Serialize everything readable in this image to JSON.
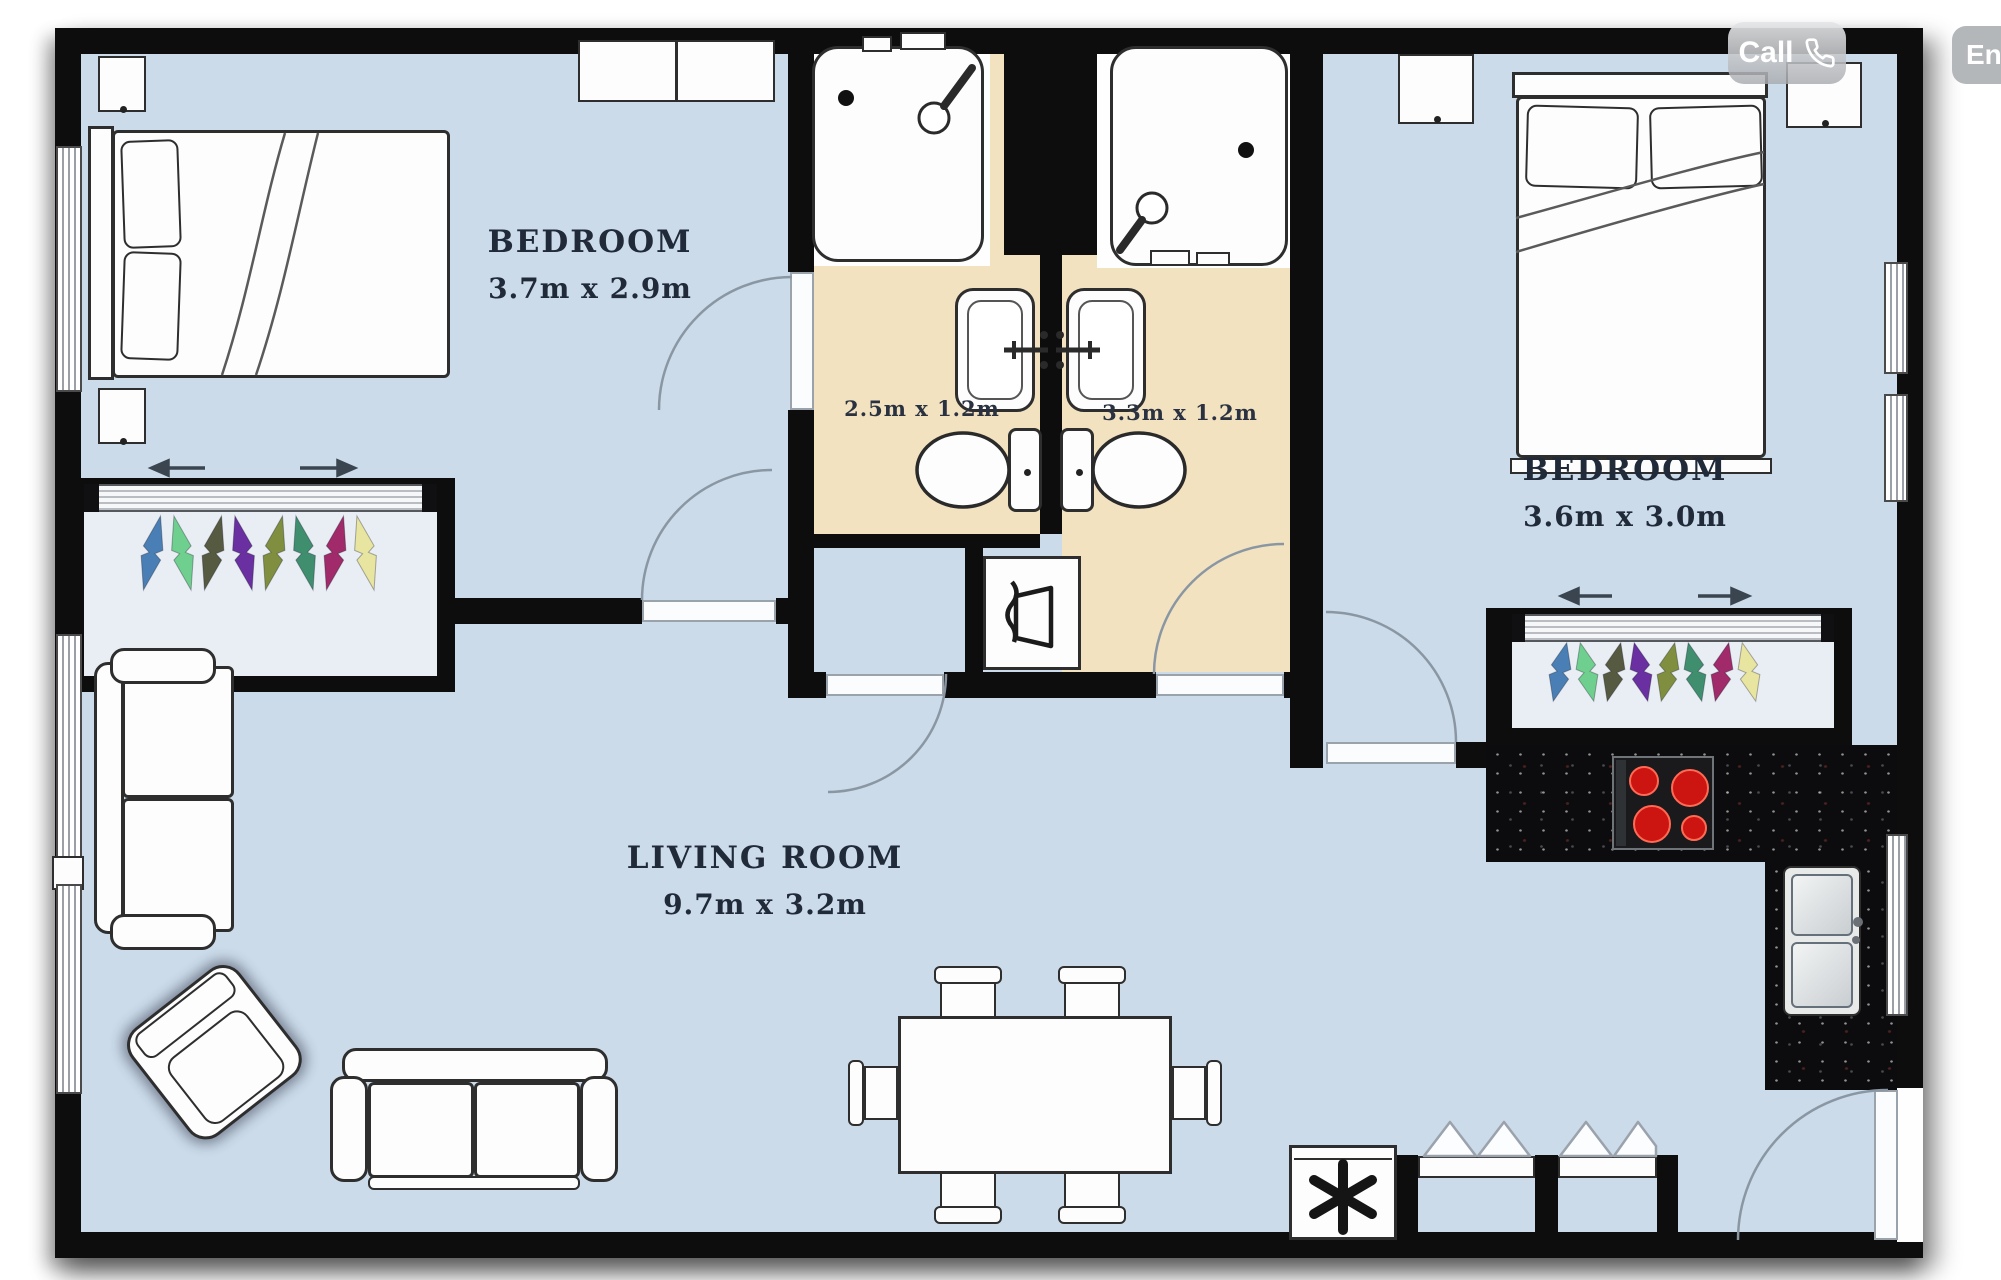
{
  "overlay_buttons": {
    "call": {
      "label": "Call",
      "icon": "phone-icon",
      "background": "#c7c9cc",
      "text_color": "#ffffff"
    },
    "enquire": {
      "label": "En",
      "background": "#b4b7ba",
      "text_color": "#ffffff"
    }
  },
  "floorplan": {
    "rooms": {
      "bedroom_left": {
        "name": "BEDROOM",
        "dimensions": "3.7m x 2.9m"
      },
      "bedroom_right": {
        "name": "BEDROOM",
        "dimensions": "3.6m x 3.0m"
      },
      "living_room": {
        "name": "LIVING ROOM",
        "dimensions": "9.7m x 3.2m"
      },
      "bathroom_left": {
        "dimensions": "2.5m x 1.2m"
      },
      "bathroom_right": {
        "dimensions": "3.3m x 1.2m"
      }
    },
    "colors": {
      "wall": "#0d0d0e",
      "floor": "#cbdbea",
      "bathroom_floor": "#f2e2c0",
      "label_text": "#202a38",
      "kitchen_counter": "#0c0c0e",
      "stove_burner": "#cc1410"
    },
    "wardrobe_clothes_colors": [
      "#4a7fb5",
      "#6fcf8e",
      "#555a40",
      "#6a2fa0",
      "#7f8f3f",
      "#3f8f6f",
      "#a02a6a",
      "#e8e5a0"
    ]
  }
}
